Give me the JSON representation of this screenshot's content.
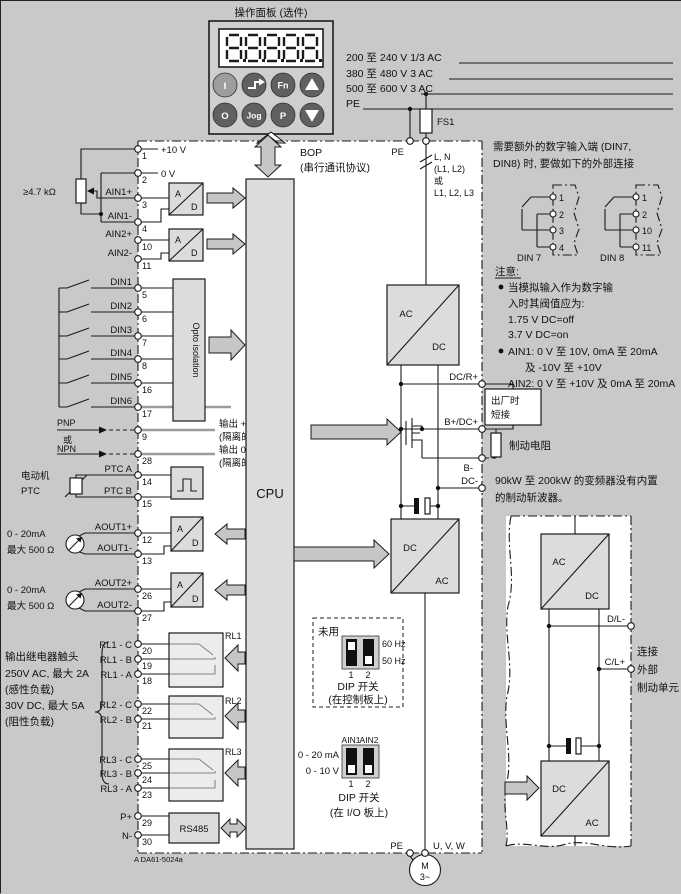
{
  "figure": {
    "doc_number": "A DA61-5024a"
  },
  "panel": {
    "title": "操作面板 (选件)",
    "display_value": "8.8.8.8.8",
    "btn_i": "I",
    "btn_fn": "Fn",
    "btn_o": "O",
    "btn_jog": "Jog",
    "btn_p": "P"
  },
  "bop": {
    "label": "BOP",
    "sub": "(串行通讯协议)"
  },
  "mains": {
    "v1": "200 至 240 V 1/3 AC",
    "v2": "380 至 480 V 3 AC",
    "v3": "500 至 600 V 3 AC",
    "pe": "PE"
  },
  "terminals": [
    {
      "n": "1",
      "l": "+10 V"
    },
    {
      "n": "2",
      "l": "0 V"
    },
    {
      "n": "3",
      "l": "AIN1+"
    },
    {
      "n": "4",
      "l": "AIN1-"
    },
    {
      "n": "10",
      "l": "AIN2+"
    },
    {
      "n": "11",
      "l": "AIN2-"
    },
    {
      "n": "5",
      "l": "DIN1"
    },
    {
      "n": "6",
      "l": "DIN2"
    },
    {
      "n": "7",
      "l": "DIN3"
    },
    {
      "n": "8",
      "l": "DIN4"
    },
    {
      "n": "16",
      "l": "DIN5"
    },
    {
      "n": "17",
      "l": "DIN6"
    },
    {
      "n": "9",
      "l": ""
    },
    {
      "n": "28",
      "l": ""
    },
    {
      "n": "14",
      "l": "PTC A"
    },
    {
      "n": "15",
      "l": "PTC B"
    },
    {
      "n": "12",
      "l": "AOUT1+"
    },
    {
      "n": "13",
      "l": "AOUT1-"
    },
    {
      "n": "26",
      "l": "AOUT2+"
    },
    {
      "n": "27",
      "l": "AOUT2-"
    },
    {
      "n": "20",
      "l": "RL1 - C"
    },
    {
      "n": "19",
      "l": "RL1 - B"
    },
    {
      "n": "18",
      "l": "RL1 - A"
    },
    {
      "n": "22",
      "l": "RL2 - C"
    },
    {
      "n": "21",
      "l": "RL2 - B"
    },
    {
      "n": "25",
      "l": "RL3 - C"
    },
    {
      "n": "24",
      "l": "RL3 - B"
    },
    {
      "n": "23",
      "l": "RL3 - A"
    },
    {
      "n": "29",
      "l": "P+"
    },
    {
      "n": "30",
      "l": "N-"
    }
  ],
  "left_notes": {
    "pot": "≥4.7 kΩ",
    "pnp": "PNP",
    "or": "或",
    "npn": "NPN",
    "motor_ptc1": "电动机",
    "motor_ptc2": "PTC",
    "aout1a": "0 - 20mA",
    "aout1b": "最大 500 Ω",
    "aout2a": "0 - 20mA",
    "aout2b": "最大 500 Ω",
    "relay1": "输出继电器触头",
    "relay2": "250V AC, 最大 2A",
    "relay3": "(感性负载)",
    "relay4": "30V DC, 最大 5A",
    "relay5": "(阻性负载)"
  },
  "blocks": {
    "ad_a": "A",
    "ad_d": "D",
    "opto": "Opto isolation",
    "cpu": "CPU",
    "rs485": "RS485",
    "rl1": "RL1",
    "rl2": "RL2",
    "rl3": "RL3",
    "iso1": "输出 +24V",
    "iso2": "(隔离的)",
    "iso3": "输出 0V",
    "iso4": "(隔离的)"
  },
  "power": {
    "ac": "AC",
    "dc": "DC",
    "fuse": "FS1",
    "pe_top": "PE",
    "pe_bottom": "PE",
    "feed1": "L, N",
    "feed2": "(L1, L2)",
    "feed3": "或",
    "feed4": "L1, L2, L3",
    "dc_r": "DC/R+",
    "b_dc": "B+/DC+",
    "b_minus": "B-",
    "dc_minus": "DC-",
    "jumper1": "出厂时",
    "jumper2": "短接",
    "brake_res": "制动电阻",
    "uvw": "U, V, W",
    "motor1": "M",
    "motor2": "3~"
  },
  "right": {
    "intro1": "需要额外的数字输入端 (DIN7,",
    "intro2": "DIN8) 时, 要做如下的外部连接",
    "din7_label": "DIN 7",
    "din8_label": "DIN 8",
    "din7_t": [
      "1",
      "2",
      "3",
      "4"
    ],
    "din8_t": [
      "1",
      "2",
      "10",
      "11"
    ],
    "note_title": "注意:",
    "n1": "当模拟输入作为数字输",
    "n2": "入时其阀值应为:",
    "n3": "1.75 V DC=off",
    "n4": "3.7 V DC=on",
    "n5": "AIN1: 0 V 至 10V, 0mA 至 20mA",
    "n6": "及 -10V 至 +10V",
    "n7": "AIN2: 0 V 至 +10V 及 0mA 至 20mA",
    "chop1": "90kW 至 200kW 的变频器没有内置",
    "chop2": "的制动斩波器。",
    "ext1": "连接",
    "ext2": "外部",
    "ext3": "制动单元",
    "dl": "D/L-",
    "cl": "C/L+"
  },
  "dip1": {
    "unused": "未用",
    "hz60": "60 Hz",
    "hz50": "50 Hz",
    "n1": "1",
    "n2": "2",
    "name": "DIP 开关",
    "loc": "(在控制板上)"
  },
  "dip2": {
    "ain1": "AIN1",
    "ain2": "AIN2",
    "ma": "0 - 20 mA",
    "v": "0 - 10 V",
    "n1": "1",
    "n2": "2",
    "name": "DIP 开关",
    "loc": "(在 I/O 板上)"
  },
  "colors": {
    "bg": "#c9c9c9",
    "paper": "#ffffff",
    "box": "#dcdcdc",
    "arrow": "#c6c6c6",
    "line": "#1a1a1a",
    "button": "#606060",
    "button_light": "#9d9d9d"
  }
}
